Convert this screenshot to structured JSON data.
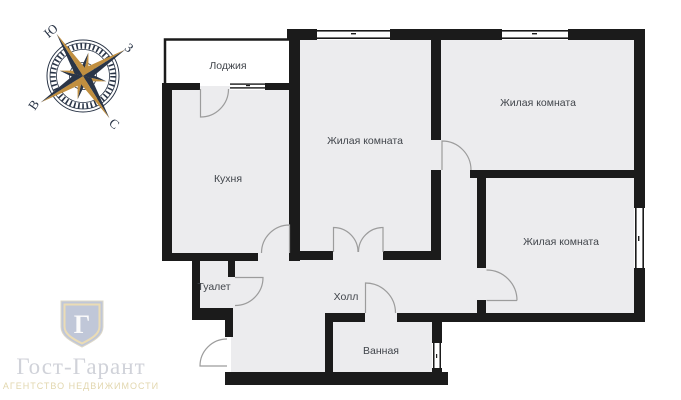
{
  "page": {
    "background": "#ffffff"
  },
  "plan": {
    "wall_color": "#1b1b1b",
    "floor_color": "#ececee",
    "door_arc_color": "#9c9c9c",
    "rooms": [
      {
        "id": "loggia",
        "label": "Лоджия"
      },
      {
        "id": "kitchen",
        "label": "Кухня"
      },
      {
        "id": "living-room-top",
        "label": "Жилая комната"
      },
      {
        "id": "living-room-right",
        "label": "Жилая комната"
      },
      {
        "id": "living-room-bottom",
        "label": "Жилая комната"
      },
      {
        "id": "toilet",
        "label": "Туалет"
      },
      {
        "id": "hall",
        "label": "Холл"
      },
      {
        "id": "bathroom",
        "label": "Ванная"
      }
    ]
  },
  "compass": {
    "navy": "#2a3547",
    "gold": "#c18f3f",
    "south_label": "Ю",
    "west_label": "З",
    "east_label": "В",
    "north_label": "С"
  },
  "logo": {
    "emblem_letter": "Г",
    "title": "Гост-Гарант",
    "subtitle": "АГЕНТСТВО НЕДВИЖИМОСТИ",
    "shield_color": "#b6bed2",
    "shield_border_color": "#e8d7a9"
  }
}
